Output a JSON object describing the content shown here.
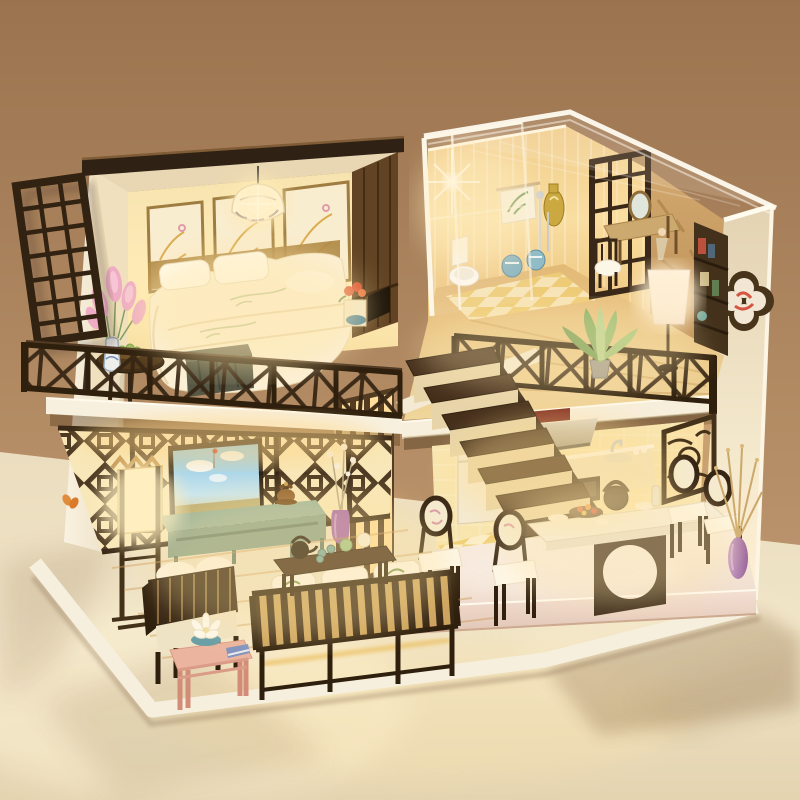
{
  "meta": {
    "alt": "Warmly lit DIY miniature dollhouse diorama in Chinese style: loft bedroom with white bed and lattice balcony on the left, glass-roofed bathroom and study loft on the right, living room with sofas and TV painting below, kitchen and dining platform with pedestal table and medallion chairs at lower right, dark wood staircase in the middle, all standing on a cream cloth against a warm brown backdrop."
  },
  "palette": {
    "background_top": "#9c7454",
    "background_bottom": "#c7a07c",
    "tablecloth": "#efe4ca",
    "wall_white": "#f7f2e3",
    "roof_dark": "#241a10",
    "wood_dark": "#2c1d10",
    "wood_mid": "#5a3d20",
    "floor_wood": "#ecc887",
    "glow_warm": "#ffe6a6",
    "glow_hot": "#fff6d8",
    "lattice_dark": "#3a2817",
    "teal_console": "#8fae9e",
    "painting_sky": "#7fc3ea",
    "flower_pink": "#efabcb",
    "vase_purple": "#a873b5",
    "plant_green": "#7fae66",
    "stool_blue": "#7fb2c4",
    "platform_pink": "#f2dfd8",
    "tile_warm": "#f3d795",
    "accent_red": "#d84a32"
  },
  "scene": {
    "objects": [
      "lattice-window-shutter",
      "bedroom",
      "bed",
      "pillows",
      "headboard-art-panels",
      "pendant-lamp",
      "wardrobe",
      "pink-flower-vase",
      "balcony-railing",
      "round-side-table",
      "foot-chest",
      "bathroom",
      "toilet",
      "towel-rack",
      "ceramic-stools",
      "lattice-screen",
      "vanity-desk",
      "loft-floor-lamp",
      "bookshelf",
      "acrylic-roof",
      "glass-wall",
      "quatrefoil-wall-decor",
      "loft-railing",
      "agave-plant",
      "living-room",
      "lattice-wall",
      "tv-painting",
      "teal-console",
      "living-floor-lamp",
      "armchair",
      "slatted-sofa",
      "coffee-table-tea-set",
      "pink-side-table",
      "lotus-bowl",
      "staircase",
      "slat-partition",
      "kitchen",
      "fridge",
      "range-hood",
      "cooktop",
      "oven",
      "sink",
      "wine-lattice-rack",
      "dining-platform",
      "pedestal-dining-table",
      "medallion-chairs",
      "teapot",
      "purple-vase",
      "dried-branches",
      "white-base",
      "table-cloth",
      "cast-shadows"
    ]
  }
}
